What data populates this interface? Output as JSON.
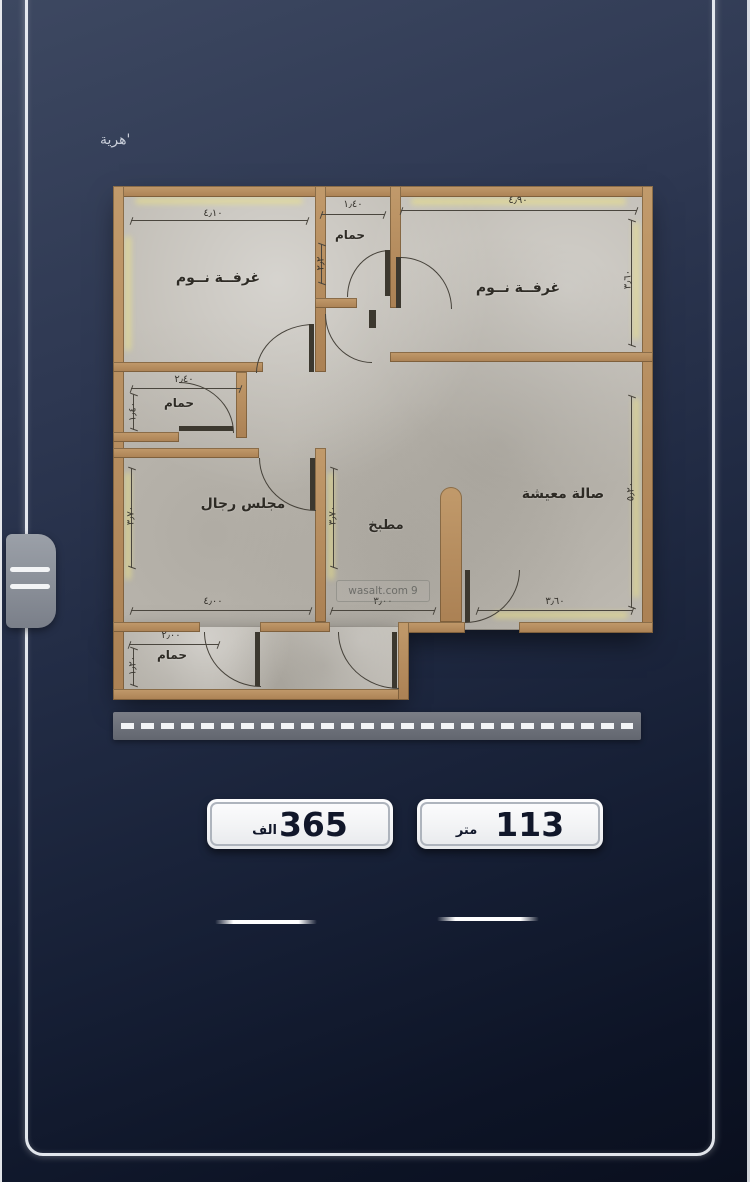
{
  "page": {
    "corner_caption": "'هرية"
  },
  "floor_plan": {
    "rooms": [
      {
        "label": "غرفــة نــوم",
        "dim_top": "٤٫١٠"
      },
      {
        "label": "حمام",
        "dim_top": "١٫٤٠",
        "dim_left": "٢٫٢"
      },
      {
        "label": "غرفــة نــوم",
        "dim_top": "٤٫٩٠",
        "dim_right": "٣٫٦٠"
      },
      {
        "label": "حمام",
        "dim_top": "٢٫٤٠",
        "dim_left": "١٫٤٠"
      },
      {
        "label": "مجلس رجال",
        "dim_bottom": "٤٫٠٠",
        "dim_left": "٣٫٧٠"
      },
      {
        "label": "مطبخ",
        "dim_bottom": "٣٫٠٠",
        "dim_left": "٣٫٧٠"
      },
      {
        "label": "صالة معيشة",
        "dim_bottom": "٣٫٦٠",
        "dim_right": "٥٫٢٠"
      },
      {
        "label": "حمام",
        "dim_top": "٢٫٠٠",
        "dim_left": "١٫٢٠"
      }
    ],
    "watermark": {
      "text": "wasalt.com",
      "pin": "9"
    }
  },
  "badges": {
    "price": {
      "value": "365",
      "unit": "الف"
    },
    "area": {
      "value": "113",
      "unit": "متر"
    }
  }
}
